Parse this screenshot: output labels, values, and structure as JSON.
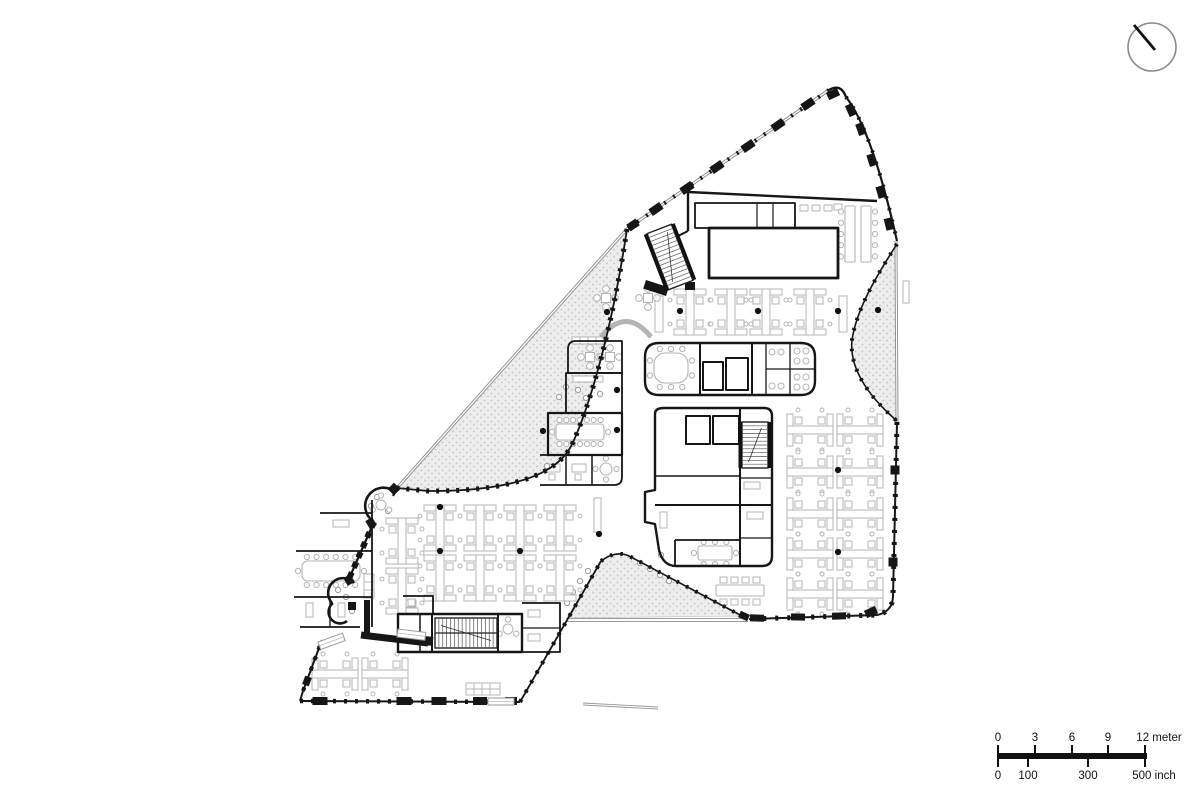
{
  "meta": {
    "drawing_type": "architectural floor plan",
    "background": "#ffffff"
  },
  "colors": {
    "wall": "#161616",
    "furniture": "#b4b4b4",
    "facade": "#8f8f8f",
    "stipple_bg": "#ededed",
    "stipple_dot": "#c2c2c2"
  },
  "north_arrow": {
    "present": true
  },
  "scale_bar": {
    "meter_labels": [
      "0",
      "3",
      "6",
      "9",
      "12 meter"
    ],
    "inch_labels": [
      "0",
      "100",
      "300",
      "500 inch"
    ]
  },
  "plan": {
    "stipple": [
      "M627,229 C612,330 590,404 574,440 C563,468 532,480 498,486 C470,491 443,491 428,491 L398,488 Z",
      "M897,244 C873,281 856,312 852,340 C849,368 868,396 897,421 Z",
      "M601,561 Q617,549 631,557 L742,616 L567,618 Z"
    ],
    "facade_dbl": [
      {
        "d": "M829,90 L627,229 L397,488",
        "w": 3.2
      },
      {
        "d": "M896,241 L897,422",
        "w": 3
      },
      {
        "d": "M566,620 L748,620",
        "w": 4,
        "c": "#9a9a9a"
      },
      {
        "d": "M583,704 L658,708",
        "w": 3,
        "c": "#9a9a9a"
      }
    ],
    "walls": [
      {
        "d": "M829,90 Q841,83 846,97",
        "w": 2.4
      },
      {
        "d": "M846,97 Q872,130 897,241",
        "w": 2.2
      },
      {
        "d": "M897,422 L893,597 Q892,612 877,615 L749,619",
        "w": 2
      },
      {
        "d": "M627,229 C612,330 590,404 574,440 C563,468 532,480 498,486 C470,491 443,491 428,491 L397,488",
        "w": 1.8
      },
      {
        "d": "M397,488 L393,496",
        "w": 2.2
      },
      {
        "d": "M374,522 L348,581",
        "w": 2.2
      },
      {
        "d": "M394,491 A13.5,13.5 0 1 0 373,521",
        "w": 2.6
      },
      {
        "d": "M354,583 A13,13 0 1 0 332,603",
        "w": 2.6
      },
      {
        "d": "M333,603 A10.5,10.5 0 1 0 347,621",
        "w": 2.6
      },
      {
        "d": "M367,600 L367,633",
        "w": 6
      },
      {
        "d": "M361,635 L428,643",
        "w": 7
      },
      {
        "d": "M303,691 L322,640",
        "w": 2
      },
      {
        "d": "M300,701 L303,691",
        "w": 2
      },
      {
        "d": "M300,701 L520,702",
        "w": 2
      },
      {
        "d": "M520,702 L601,561",
        "w": 1.8
      },
      {
        "d": "M601,561 Q617,549 631,557 L742,616",
        "w": 1.6
      },
      {
        "d": "M897,244 C873,281 856,312 852,340 C849,368 868,396 897,421",
        "w": 1.6
      },
      {
        "d": "M688,192 L877,201",
        "w": 2.4
      },
      {
        "d": "M688,192 L688,231",
        "w": 2.4
      },
      {
        "d": "M688,231 L666,242",
        "w": 2
      },
      {
        "d": "M695,203 L795,203 L795,228 L695,228 Z",
        "w": 1.8
      },
      {
        "d": "M757,203 L757,228",
        "w": 1.2
      },
      {
        "d": "M773,203 L773,228",
        "w": 1.2
      },
      {
        "d": "M709,228 L838,228 L838,278 L709,278 Z",
        "w": 2.8
      },
      {
        "d": "M659,343 L801,343 Q815,343 815,357 L815,381 Q815,395 801,395 L659,395 Q645,395 645,381 L645,357 Q645,343 659,343 Z",
        "w": 2.4
      },
      {
        "d": "M700,343 L700,395",
        "w": 2
      },
      {
        "d": "M703,362 L723,362 L723,390 L703,390 Z",
        "w": 2
      },
      {
        "d": "M726,358 L748,358 L748,390 L726,390 Z",
        "w": 2
      },
      {
        "d": "M752,343 L752,395",
        "w": 2
      },
      {
        "d": "M766,343 L766,395",
        "w": 1.3
      },
      {
        "d": "M790,343 L790,395",
        "w": 1.3
      },
      {
        "d": "M766,369 L815,369",
        "w": 1.3
      },
      {
        "d": "M664,408 L764,408 Q772,408 772,416 L772,556 Q772,566 762,566 L676,566 Q663,566 659,550 L655,524 L645,522 L645,492 L655,490 L655,414 Q655,408 664,408 Z",
        "w": 2.4
      },
      {
        "d": "M686,416 L710,416 L710,444 L686,444 Z",
        "w": 2
      },
      {
        "d": "M713,416 L739,416 L739,444 L713,444 Z",
        "w": 2
      },
      {
        "d": "M740,408 L740,566",
        "w": 2
      },
      {
        "d": "M655,476 L740,476",
        "w": 1.6
      },
      {
        "d": "M655,505 L772,505",
        "w": 2
      },
      {
        "d": "M675,540 L740,540",
        "w": 1.8
      },
      {
        "d": "M675,540 L675,566",
        "w": 1.8
      },
      {
        "d": "M740,448 L772,448",
        "w": 1.3
      },
      {
        "d": "M740,478 L772,478",
        "w": 1.3
      },
      {
        "d": "M740,538 L772,538",
        "w": 1.3
      },
      {
        "d": "M576,341 L622,341 L622,373 L568,373 L568,349 Q568,341 576,341 Z",
        "w": 1.8
      },
      {
        "d": "M566,373 L622,373 L622,413 L566,413 Z",
        "w": 1.8
      },
      {
        "d": "M548,413 L622,413 L622,455 L548,455 Z",
        "w": 2.2
      },
      {
        "d": "M540,455 L622,455 L622,477 Q622,485 614,485 L540,485",
        "w": 1.8
      },
      {
        "d": "M566,455 L566,485",
        "w": 1.5
      },
      {
        "d": "M592,455 L592,485",
        "w": 1.5
      },
      {
        "d": "M320,513 L372,513",
        "w": 1.8
      },
      {
        "d": "M372,500 L372,627",
        "w": 1.8
      },
      {
        "d": "M296,551 L372,551",
        "w": 1.8
      },
      {
        "d": "M294,597 L372,597",
        "w": 1.8
      },
      {
        "d": "M300,627 L360,627",
        "w": 1.8
      },
      {
        "d": "M330,597 L330,627",
        "w": 1.3
      },
      {
        "d": "M398,614 L522,614 L522,652 L398,652 Z",
        "w": 2.4
      },
      {
        "d": "M420,614 L420,652",
        "w": 1.5
      },
      {
        "d": "M432,614 L432,652",
        "w": 2
      },
      {
        "d": "M498,614 L498,652",
        "w": 2
      },
      {
        "d": "M403,596 L433,596 L433,614",
        "w": 1.8
      },
      {
        "d": "M522,603 L560,603 L560,652 L522,652",
        "w": 1.8
      },
      {
        "d": "M522,628 L560,628",
        "w": 1.3
      }
    ],
    "dashes": [
      {
        "d": "M829,90 L627,229",
        "w": 4,
        "a": "2 9"
      },
      {
        "d": "M846,97 Q872,130 897,241",
        "w": 4,
        "a": "2 10"
      },
      {
        "d": "M897,422 L893,597 Q892,612 877,615 L749,619",
        "w": 5,
        "a": "3 9"
      },
      {
        "d": "M627,229 C612,330 590,404 574,440 C563,468 532,480 498,486 C470,491 443,491 428,491 L397,488",
        "w": 5,
        "a": "3 7"
      },
      {
        "d": "M374,522 L348,581",
        "w": 6,
        "a": "6 5"
      },
      {
        "d": "M303,691 L322,640",
        "w": 4,
        "a": "4 7"
      },
      {
        "d": "M300,701 L520,702",
        "w": 4.5,
        "a": "3 8"
      },
      {
        "d": "M520,702 L601,561",
        "w": 4,
        "a": "3 8"
      },
      {
        "d": "M601,561 Q617,549 631,557 L742,616",
        "w": 4,
        "a": "2.5 8"
      },
      {
        "d": "M897,244 C873,281 856,312 852,340 C849,368 868,396 897,421",
        "w": 4,
        "a": "2.5 8"
      }
    ],
    "col_marks": [
      [
        808,
        104,
        13,
        8,
        -34
      ],
      [
        778,
        125,
        13,
        8,
        -34
      ],
      [
        748,
        146,
        13,
        8,
        -34
      ],
      [
        717,
        167,
        13,
        8,
        -34
      ],
      [
        687,
        188,
        13,
        8,
        -34
      ],
      [
        656,
        209,
        13,
        8,
        -34
      ],
      [
        633,
        225,
        11,
        8,
        -34
      ],
      [
        833,
        94,
        12,
        8,
        -25
      ],
      [
        851,
        110,
        12,
        8,
        66
      ],
      [
        861,
        129,
        12,
        8,
        70
      ],
      [
        872,
        160,
        12,
        8,
        72
      ],
      [
        881,
        192,
        12,
        8,
        74
      ],
      [
        889,
        224,
        12,
        8,
        76
      ],
      [
        895,
        470,
        9,
        9,
        0
      ],
      [
        893,
        562,
        9,
        9,
        0
      ],
      [
        757,
        618,
        14,
        7,
        2
      ],
      [
        798,
        617,
        14,
        7,
        1
      ],
      [
        839,
        616,
        14,
        7,
        -2
      ],
      [
        871,
        612,
        12,
        8,
        -25
      ],
      [
        320,
        701,
        15,
        8,
        0
      ],
      [
        404,
        701,
        15,
        8,
        0
      ],
      [
        439,
        701,
        15,
        8,
        0
      ],
      [
        480,
        701,
        14,
        8,
        0
      ],
      [
        511,
        701,
        12,
        8,
        0
      ],
      [
        307,
        681,
        9,
        7,
        -70
      ],
      [
        394,
        489,
        9,
        9,
        45
      ],
      [
        371,
        523,
        9,
        8,
        60
      ],
      [
        349,
        580,
        9,
        8,
        60
      ],
      [
        352,
        606,
        8,
        8,
        0
      ],
      [
        744,
        616,
        10,
        7,
        25
      ],
      [
        656,
        288,
        24,
        9,
        18
      ],
      [
        690,
        286,
        10,
        8,
        0
      ],
      [
        429,
        641,
        8,
        9,
        5
      ]
    ],
    "lt_rects": [
      [
        572,
        337,
        34,
        7
      ],
      [
        573,
        376,
        30,
        6
      ],
      [
        546,
        464,
        14,
        8
      ],
      [
        572,
        464,
        14,
        8
      ],
      [
        549,
        474,
        6,
        6
      ],
      [
        575,
        474,
        6,
        6
      ],
      [
        333,
        520,
        16,
        7
      ],
      [
        306,
        603,
        7,
        14
      ],
      [
        338,
        603,
        7,
        14
      ],
      [
        744,
        452,
        16,
        7
      ],
      [
        744,
        482,
        16,
        7
      ],
      [
        747,
        512,
        16,
        7
      ],
      [
        660,
        512,
        7,
        16
      ],
      [
        800,
        205,
        8,
        6
      ],
      [
        812,
        205,
        8,
        6
      ],
      [
        824,
        205,
        8,
        6
      ],
      [
        834,
        204,
        8,
        6
      ],
      [
        655,
        296,
        8,
        36
      ],
      [
        839,
        296,
        8,
        36
      ],
      [
        594,
        498,
        7,
        34
      ],
      [
        364,
        574,
        10,
        24
      ],
      [
        903,
        281,
        6,
        22
      ],
      [
        466,
        683,
        34,
        12
      ],
      [
        528,
        610,
        12,
        7
      ],
      [
        528,
        634,
        12,
        7
      ],
      [
        406,
        600,
        10,
        7
      ],
      [
        720,
        577,
        7,
        6
      ],
      [
        731,
        577,
        7,
        6
      ],
      [
        742,
        577,
        7,
        6
      ],
      [
        753,
        577,
        7,
        6
      ],
      [
        720,
        599,
        7,
        6
      ],
      [
        731,
        599,
        7,
        6
      ],
      [
        742,
        599,
        7,
        6
      ],
      [
        753,
        599,
        7,
        6
      ]
    ],
    "lt_lines": [
      "M580,337 L580,344",
      "M588,337 L588,344",
      "M596,337 L596,344",
      "M604,337 L604,344",
      "M466,689 L500,689",
      "M474,683 L474,695",
      "M482,683 L482,695",
      "M490,683 L490,695",
      "M364,582 L374,582",
      "M364,590 L374,590",
      "M848,220 L855,220",
      "M848,234 L855,234",
      "M848,248 L855,248",
      "M864,220 L871,220",
      "M864,234 L871,234",
      "M864,248 L871,248"
    ],
    "circles_lt": [
      [
        772,
        352,
        3
      ],
      [
        781,
        352,
        3
      ],
      [
        772,
        386,
        3
      ],
      [
        781,
        386,
        3
      ],
      [
        797,
        351,
        3
      ],
      [
        806,
        351,
        3
      ],
      [
        797,
        361,
        3
      ],
      [
        806,
        361,
        3
      ],
      [
        797,
        377,
        3
      ],
      [
        806,
        377,
        3
      ],
      [
        797,
        387,
        3
      ],
      [
        806,
        387,
        3
      ]
    ],
    "odots": [
      [
        566,
        387
      ],
      [
        559,
        397
      ],
      [
        547,
        466
      ],
      [
        578,
        390
      ],
      [
        586,
        398
      ],
      [
        600,
        394
      ],
      [
        338,
        590
      ],
      [
        346,
        597
      ],
      [
        352,
        611
      ],
      [
        377,
        497
      ],
      [
        371,
        506
      ],
      [
        388,
        511
      ],
      [
        661,
        555
      ],
      [
        567,
        603
      ],
      [
        573,
        592
      ],
      [
        580,
        581
      ],
      [
        588,
        571
      ],
      [
        640,
        563
      ],
      [
        650,
        569
      ],
      [
        660,
        575
      ],
      [
        669,
        581
      ]
    ],
    "arc_sofa": {
      "d": "M601,337 Q626,306 651,337",
      "w": 5
    },
    "cross_tables": [
      [
        590,
        357
      ],
      [
        610,
        357
      ],
      [
        606,
        298
      ],
      [
        648,
        298
      ]
    ],
    "round_tables": [
      {
        "x": 508,
        "y": 629,
        "rad": 5,
        "n": 3
      },
      {
        "x": 606,
        "y": 469,
        "rad": 6,
        "n": 4
      },
      {
        "x": 381,
        "y": 505,
        "rad": 5,
        "n": 3
      }
    ],
    "long_tables": [
      {
        "x": 302,
        "y": 561,
        "w": 58,
        "h": 20,
        "rx": 6,
        "ct": 6,
        "cb": 6,
        "cl": 1,
        "cr": 1
      },
      {
        "x": 556,
        "y": 424,
        "w": 48,
        "h": 16,
        "rx": 3,
        "ct": 7,
        "cb": 7,
        "cl": 1,
        "cr": 1
      },
      {
        "x": 654,
        "y": 353,
        "w": 34,
        "h": 30,
        "rx": 11,
        "ct": 3,
        "cb": 3,
        "cl": 2,
        "cr": 2
      },
      {
        "x": 698,
        "y": 546,
        "w": 34,
        "h": 14,
        "rx": 2,
        "ct": 3,
        "cb": 3,
        "cl": 1,
        "cr": 1
      },
      {
        "x": 716,
        "y": 585,
        "w": 48,
        "h": 11,
        "rx": 1
      },
      {
        "x": 845,
        "y": 206,
        "w": 10,
        "h": 56,
        "rx": 1,
        "cl": 5
      },
      {
        "x": 861,
        "y": 206,
        "w": 10,
        "h": 56,
        "rx": 1,
        "cr": 5
      }
    ],
    "clusters": [
      {
        "x": 690,
        "y": 312,
        "r": 0,
        "n": 1
      },
      {
        "x": 731,
        "y": 312,
        "r": 0,
        "n": 1
      },
      {
        "x": 766,
        "y": 312,
        "r": 0,
        "n": 1
      },
      {
        "x": 810,
        "y": 312,
        "r": 0,
        "n": 1
      },
      {
        "x": 402,
        "y": 566,
        "r": 0,
        "n": 2
      },
      {
        "x": 440,
        "y": 553,
        "r": 0,
        "n": 2
      },
      {
        "x": 480,
        "y": 553,
        "r": 0,
        "n": 2
      },
      {
        "x": 520,
        "y": 553,
        "r": 0,
        "n": 2
      },
      {
        "x": 560,
        "y": 553,
        "r": 0,
        "n": 2
      },
      {
        "x": 835,
        "y": 430,
        "r": 90,
        "n": 2
      },
      {
        "x": 835,
        "y": 472,
        "r": 90,
        "n": 2
      },
      {
        "x": 835,
        "y": 514,
        "r": 90,
        "n": 2
      },
      {
        "x": 835,
        "y": 554,
        "r": 90,
        "n": 2
      },
      {
        "x": 835,
        "y": 594,
        "r": 90,
        "n": 2
      },
      {
        "x": 360,
        "y": 674,
        "r": 90,
        "n": 2
      }
    ],
    "stairs": [
      {
        "x": 670,
        "y": 257,
        "w": 26,
        "h": 60,
        "rot": -21,
        "n": 13,
        "side": 1
      },
      {
        "x": 755,
        "y": 445,
        "w": 26,
        "h": 46,
        "rot": 0,
        "n": 11,
        "side": 1
      },
      {
        "x": 466,
        "y": 633,
        "w": 30,
        "h": 62,
        "rot": 90,
        "n": 15,
        "mid": 1
      }
    ],
    "doors": [
      [
        488,
        698,
        26,
        7,
        0
      ],
      [
        398,
        629,
        28,
        8,
        7
      ],
      [
        318,
        642,
        26,
        8,
        -20
      ]
    ],
    "dots": [
      [
        680,
        311
      ],
      [
        758,
        311
      ],
      [
        838,
        311
      ],
      [
        878,
        310
      ],
      [
        607,
        312
      ],
      [
        617,
        390
      ],
      [
        617,
        430
      ],
      [
        543,
        431
      ],
      [
        440,
        507
      ],
      [
        440,
        551
      ],
      [
        520,
        551
      ],
      [
        599,
        534
      ],
      [
        838,
        470
      ],
      [
        838,
        552
      ]
    ]
  }
}
